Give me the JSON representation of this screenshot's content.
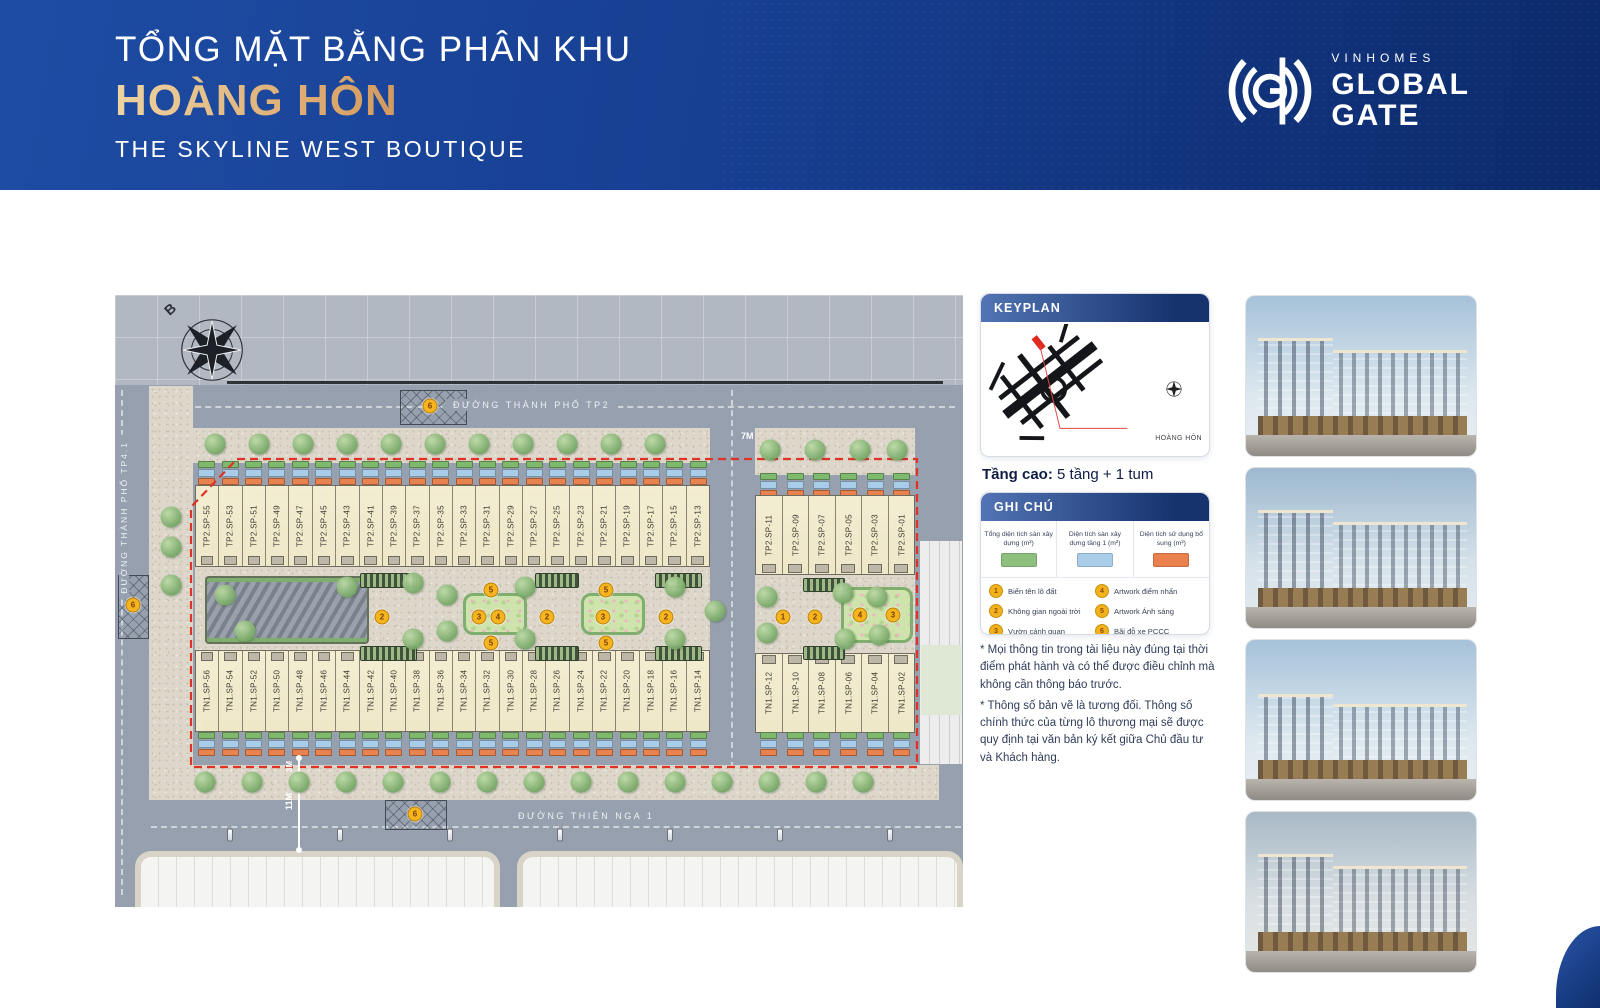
{
  "header": {
    "title_line1": "TỔNG MẶT BẰNG PHÂN KHU",
    "title_line2": "HOÀNG HÔN",
    "title_line3": "THE SKYLINE WEST BOUTIQUE",
    "brand": {
      "name_top": "VINHOMES",
      "name_mid": "GLOBAL",
      "name_bot": "GATE"
    },
    "colors": {
      "band_start": "#1e4ca4",
      "band_end": "#0c2a6b",
      "accent_gold": "#d9a468"
    }
  },
  "plan": {
    "compass_label": "B",
    "streets": {
      "top": "ĐƯỜNG THÀNH PHỐ TP2",
      "left": "ĐƯỜNG THÀNH PHỐ TP4.1",
      "bottom": "ĐƯỜNG THIÊN NGA 1"
    },
    "dimension_labels": {
      "road_gap": "7M",
      "bottom_road": "11M",
      "sidewalk": "3M"
    },
    "chip_colors": [
      "#7fb96e",
      "#a9cde9",
      "#e8824f"
    ],
    "lot_rows": {
      "top_left": [
        "TP2.SP-55",
        "TP2.SP-53",
        "TP2.SP-51",
        "TP2.SP-49",
        "TP2.SP-47",
        "TP2.SP-45",
        "TP2.SP-43",
        "TP2.SP-41",
        "TP2.SP-39",
        "TP2.SP-37",
        "TP2.SP-35",
        "TP2.SP-33",
        "TP2.SP-31",
        "TP2.SP-29",
        "TP2.SP-27",
        "TP2.SP-25",
        "TP2.SP-23",
        "TP2.SP-21",
        "TP2.SP-19",
        "TP2.SP-17",
        "TP2.SP-15",
        "TP2.SP-13"
      ],
      "top_right": [
        "TP2.SP-11",
        "TP2.SP-09",
        "TP2.SP-07",
        "TP2.SP-05",
        "TP2.SP-03",
        "TP2.SP-01"
      ],
      "bottom_left": [
        "TN1.SP-56",
        "TN1.SP-54",
        "TN1.SP-52",
        "TN1.SP-50",
        "TN1.SP-48",
        "TN1.SP-46",
        "TN1.SP-44",
        "TN1.SP-42",
        "TN1.SP-40",
        "TN1.SP-38",
        "TN1.SP-36",
        "TN1.SP-34",
        "TN1.SP-32",
        "TN1.SP-30",
        "TN1.SP-28",
        "TN1.SP-26",
        "TN1.SP-24",
        "TN1.SP-22",
        "TN1.SP-20",
        "TN1.SP-18",
        "TN1.SP-16",
        "TN1.SP-14"
      ],
      "bottom_right": [
        "TN1.SP-12",
        "TN1.SP-10",
        "TN1.SP-08",
        "TN1.SP-06",
        "TN1.SP-04",
        "TN1.SP-02"
      ]
    },
    "markers": [
      {
        "n": "6",
        "x": 18,
        "y": 310
      },
      {
        "n": "6",
        "x": 315,
        "y": 111
      },
      {
        "n": "6",
        "x": 300,
        "y": 519
      },
      {
        "n": "5",
        "x": 376,
        "y": 295
      },
      {
        "n": "2",
        "x": 267,
        "y": 322
      },
      {
        "n": "3",
        "x": 364,
        "y": 322
      },
      {
        "n": "4",
        "x": 383,
        "y": 322
      },
      {
        "n": "5",
        "x": 376,
        "y": 348
      },
      {
        "n": "2",
        "x": 432,
        "y": 322
      },
      {
        "n": "5",
        "x": 491,
        "y": 295
      },
      {
        "n": "3",
        "x": 488,
        "y": 322
      },
      {
        "n": "5",
        "x": 491,
        "y": 348
      },
      {
        "n": "2",
        "x": 551,
        "y": 322
      },
      {
        "n": "1",
        "x": 668,
        "y": 322
      },
      {
        "n": "2",
        "x": 700,
        "y": 322
      },
      {
        "n": "4",
        "x": 745,
        "y": 320
      },
      {
        "n": "3",
        "x": 778,
        "y": 320
      }
    ]
  },
  "sidebar": {
    "keyplan": {
      "title": "KEYPLAN",
      "callout": "HOÀNG HÔN"
    },
    "floors_label": "Tầng cao:",
    "floors_value": " 5 tầng + 1 tum",
    "legend": {
      "title": "GHI CHÚ",
      "swatches": [
        {
          "label": "Tổng diện tích sàn xây dựng (m²)",
          "color": "#8cc07c"
        },
        {
          "label": "Diện tích sàn xây dựng tầng 1 (m²)",
          "color": "#aacdea"
        },
        {
          "label": "Diện tích sử dụng bổ sung (m²)",
          "color": "#e8814e"
        }
      ],
      "items": [
        {
          "num": "1",
          "label": "Biển tên lô đất"
        },
        {
          "num": "2",
          "label": "Không gian ngoài trời"
        },
        {
          "num": "3",
          "label": "Vườn cảnh quan"
        },
        {
          "num": "4",
          "label": "Artwork điểm nhấn"
        },
        {
          "num": "5",
          "label": "Artwork Ánh sáng"
        },
        {
          "num": "6",
          "label": "Bãi đỗ xe PCCC"
        }
      ]
    },
    "notes": [
      "* Mọi thông tin trong tài liệu này đúng tại thời điểm phát hành và có thể được điều chỉnh mà không cần thông báo trước.",
      "* Thông số bản vẽ là tương đối. Thông số chính thức của từng lô thương mại sẽ được quy định tại văn bản ký kết giữa Chủ đầu tư và Khách hàng."
    ]
  },
  "gallery": {
    "photos": [
      "building-render-1",
      "building-render-2",
      "building-render-3",
      "building-render-4"
    ]
  }
}
